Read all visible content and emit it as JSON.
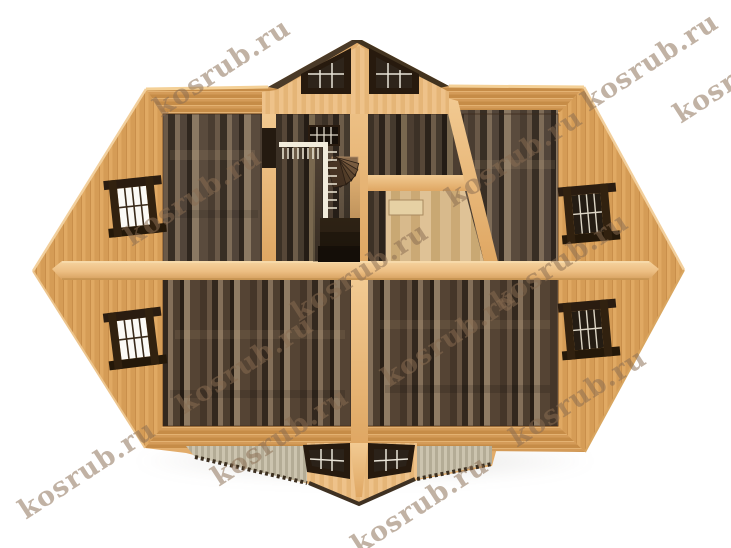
{
  "scene": {
    "type": "3d-architectural-render",
    "subject": "Top-down cutaway 3D plan of the attic storey of a wooden log house",
    "background_color": "#ffffff"
  },
  "watermark": {
    "text": "kosrub.ru",
    "color": "#8a6d52",
    "opacity": 0.52,
    "rotation_deg": -33,
    "font_size_px": 27,
    "instances": [
      {
        "x": 222,
        "y": 68
      },
      {
        "x": 650,
        "y": 62
      },
      {
        "x": 742,
        "y": 74
      },
      {
        "x": 514,
        "y": 158
      },
      {
        "x": 193,
        "y": 197
      },
      {
        "x": 560,
        "y": 262
      },
      {
        "x": 360,
        "y": 272
      },
      {
        "x": 450,
        "y": 338
      },
      {
        "x": 245,
        "y": 365
      },
      {
        "x": 578,
        "y": 398
      },
      {
        "x": 87,
        "y": 470
      },
      {
        "x": 280,
        "y": 437
      },
      {
        "x": 420,
        "y": 505
      }
    ]
  },
  "palette": {
    "roof_tan": "#e0a963",
    "roof_stripe": "#d59c56",
    "eave_band": "#d49b58",
    "wall_light_top": "#f2ca92",
    "wall_light_bottom": "#dfa763",
    "dormer_face": "#eec28a",
    "dormer_roof_dark": "#4a3a28",
    "floor_dark": "#4a3d31",
    "floor_light_room": "#d8ba8c",
    "window_frame": "#2a1c10",
    "glazing_light": "#fbfaf6",
    "glazing_dark": "#241c13",
    "porch_gray": "#ccc4af",
    "railing_white": "#f2ecdc"
  },
  "structure": {
    "rooms": [
      "top-left-room",
      "top-right-room",
      "bottom-left-room",
      "bottom-right-room",
      "stair-hall",
      "small-closet-room"
    ],
    "features": [
      "staircase-with-railing",
      "middle-partition-wall",
      "center-partition-wall",
      "floor-hatch"
    ],
    "windows": {
      "left_roof_slope": 2,
      "right_roof_slope": 2,
      "top_dormer": 2,
      "bottom_dormer": 2,
      "stairwell_back_wall": 1
    }
  }
}
